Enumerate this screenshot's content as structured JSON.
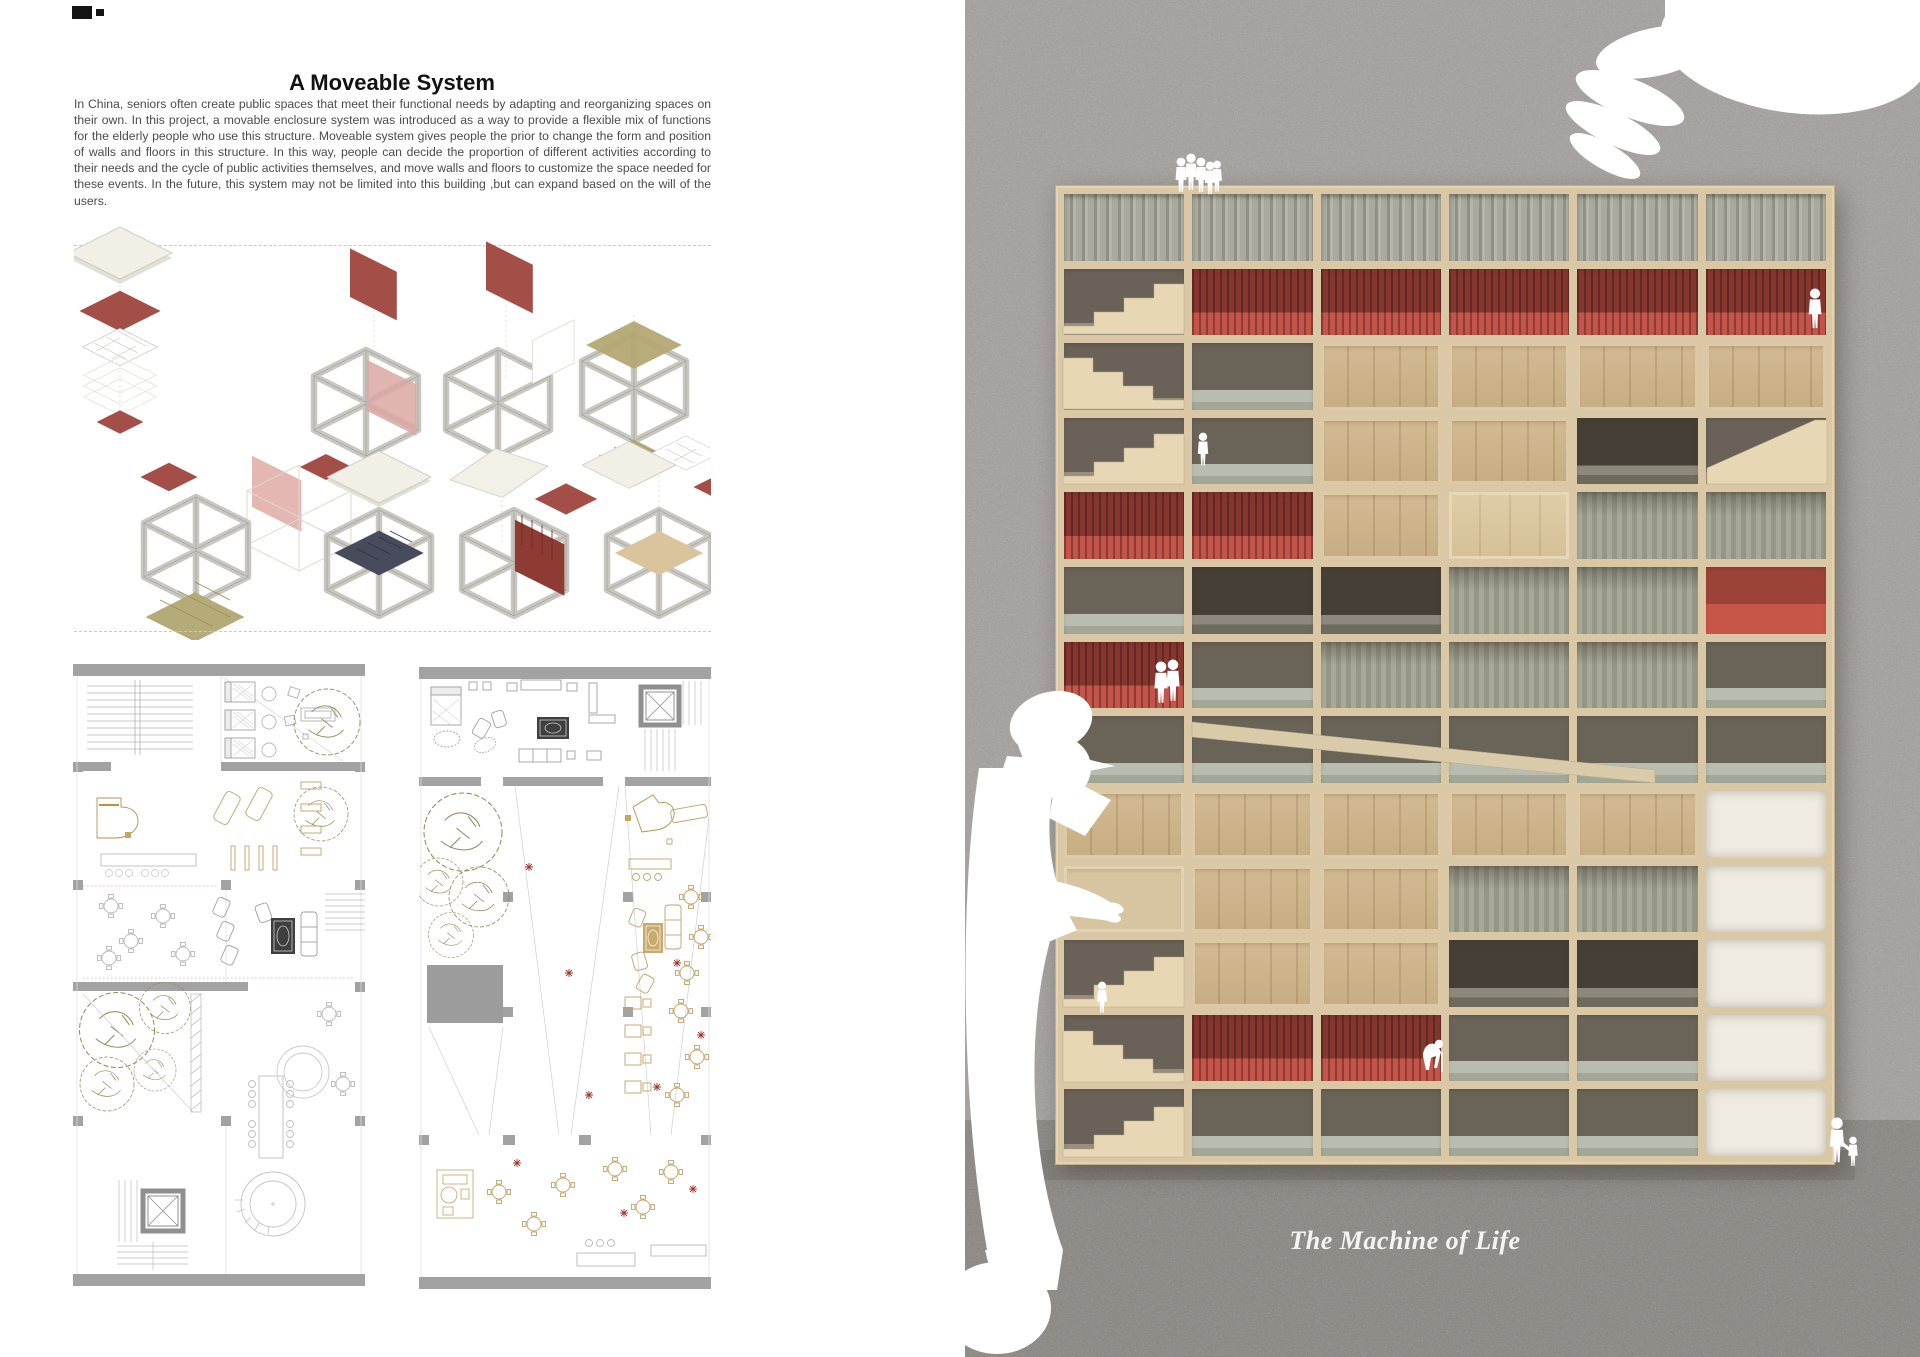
{
  "left": {
    "title": "A Moveable System",
    "paragraph": "In China, seniors often create public spaces that meet their functional needs by adapting and reorganizing spaces on their own. In this project, a movable enclosure system was introduced as a way to provide a flexible mix of functions for the elderly people who use this structure. Moveable system gives people the prior to change the form and position of walls and floors in this structure. In this way, people can decide the proportion of different activities according to their needs and the cycle of public activities themselves, and move walls and floors to customize the space needed for these events. In the future, this system may not be limited into this building ,but can expand based on the will of the users."
  },
  "right": {
    "caption": "The Machine of Life"
  },
  "colors": {
    "accent_red": "#9e4a43",
    "pink_panel": "#d9a8a3",
    "olive_floor": "#b2a873",
    "cardboard": "#d9c7a5",
    "red_floor": "#c05147",
    "gray_floor": "#b9bdb0",
    "photo_wall": "#a3a09d",
    "photo_ground": "#8e8b87"
  },
  "model": {
    "columns": 6,
    "rows": [
      [
        "corr",
        "corr",
        "corr",
        "corr",
        "corr",
        "corr"
      ],
      [
        "stair",
        "red",
        "red",
        "red",
        "red",
        "red"
      ],
      [
        "stair",
        "open",
        "tan",
        "tan",
        "tan",
        "tan"
      ],
      [
        "stair",
        "open",
        "tan",
        "tan",
        "dark",
        "stairR"
      ],
      [
        "red",
        "red",
        "tan",
        "tanL",
        "curtain",
        "curtain"
      ],
      [
        "open",
        "dark",
        "dark",
        "curtain",
        "curtain",
        "redB"
      ],
      [
        "red",
        "open",
        "curtain",
        "curtain",
        "curtain",
        "open"
      ],
      [
        "open",
        "ramp",
        "ramp",
        "ramp",
        "open",
        "open"
      ],
      [
        "tan",
        "tan",
        "tan",
        "tan",
        "tan",
        "white"
      ],
      [
        "plain",
        "tan",
        "tan",
        "curtain",
        "curtain",
        "white"
      ],
      [
        "stair",
        "tan",
        "tan",
        "dark",
        "dark",
        "white"
      ],
      [
        "stair",
        "red",
        "red",
        "open",
        "open",
        "white"
      ],
      [
        "stair",
        "open",
        "open",
        "open",
        "open",
        "white"
      ]
    ]
  }
}
